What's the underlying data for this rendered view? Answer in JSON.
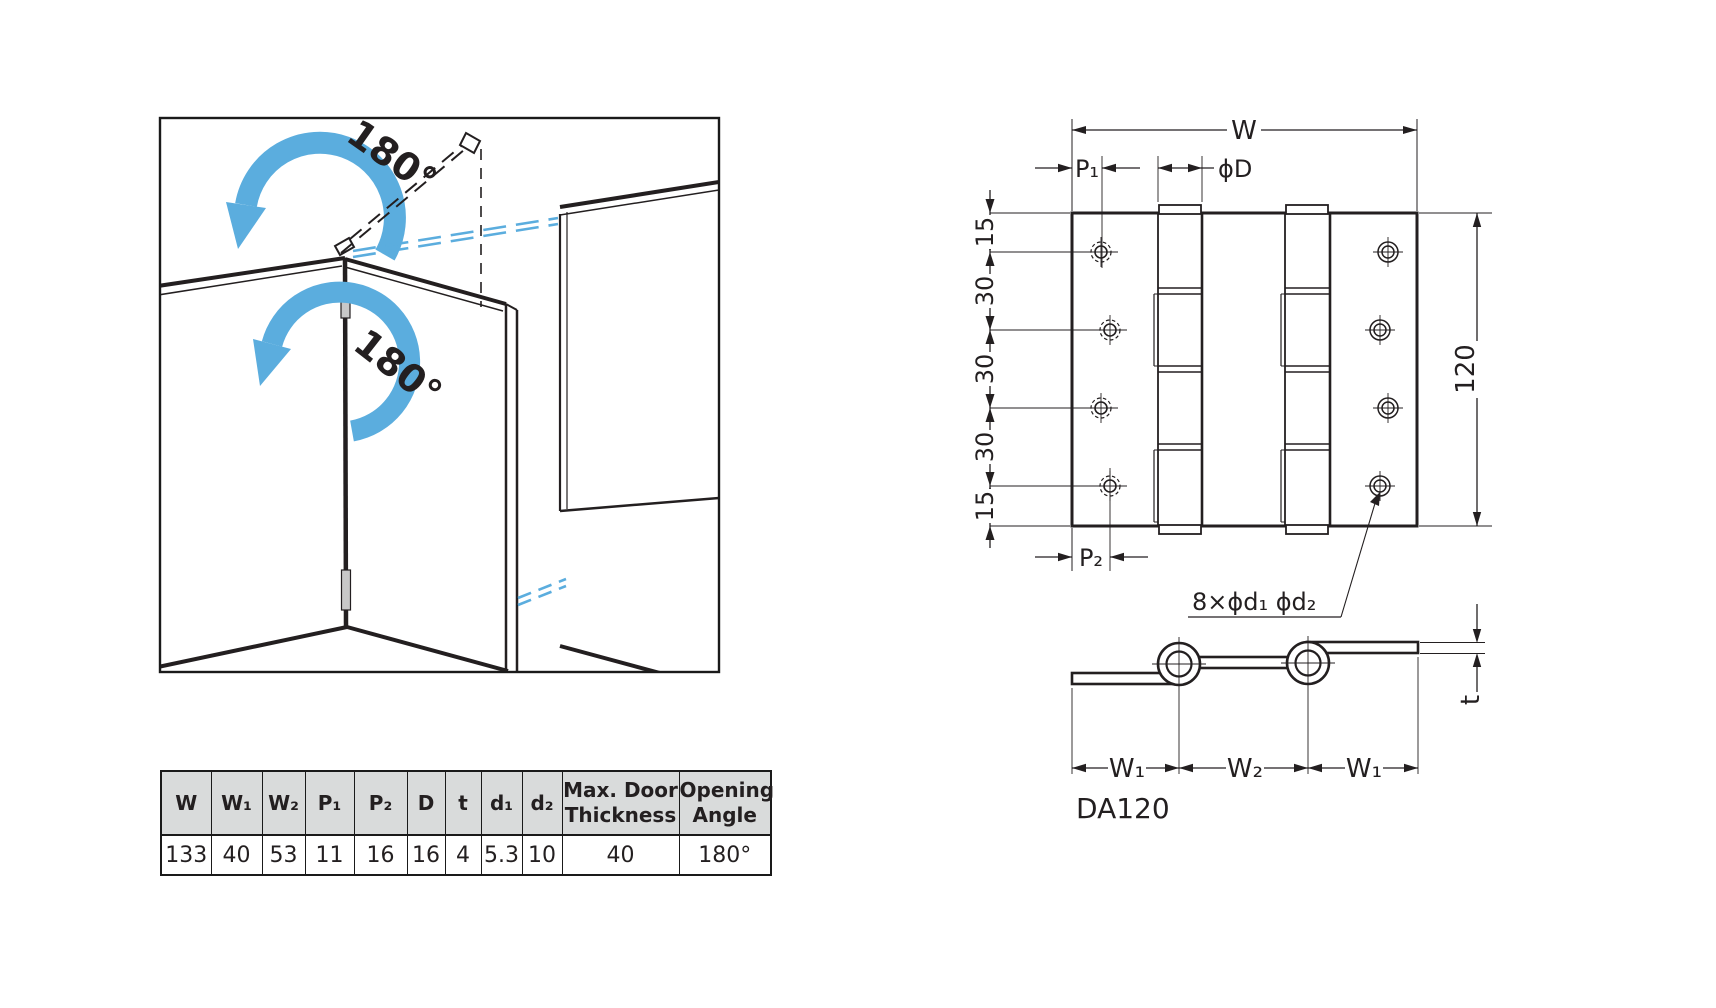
{
  "illustration": {
    "top_angle_label": "180°",
    "bottom_angle_label": "180°"
  },
  "drawing": {
    "plan": {
      "width_label": "W",
      "p1_label": "P₁",
      "diameter_label": "ϕD",
      "left_dims": [
        "15",
        "30",
        "30",
        "30",
        "15"
      ],
      "height_label": "120",
      "p2_label": "P₂",
      "holes_callout": "8×ϕd₁ ϕd₂"
    },
    "section": {
      "w1_left_label": "W₁",
      "w2_label": "W₂",
      "w1_right_label": "W₁",
      "thickness_label": "t"
    },
    "model_number": "DA120"
  },
  "spec_table": {
    "headers": [
      "W",
      "W₁",
      "W₂",
      "P₁",
      "P₂",
      "D",
      "t",
      "d₁",
      "d₂",
      "Max. Door\nThickness",
      "Opening\nAngle"
    ],
    "values": [
      "133",
      "40",
      "53",
      "11",
      "16",
      "16",
      "4",
      "5.3",
      "10",
      "40",
      "180°"
    ]
  },
  "colors": {
    "arrow_blue": "#5badde",
    "line_dark": "#231f20",
    "table_header_bg": "#d9dbdb",
    "knuckle_gray": "#c8c8c8"
  }
}
